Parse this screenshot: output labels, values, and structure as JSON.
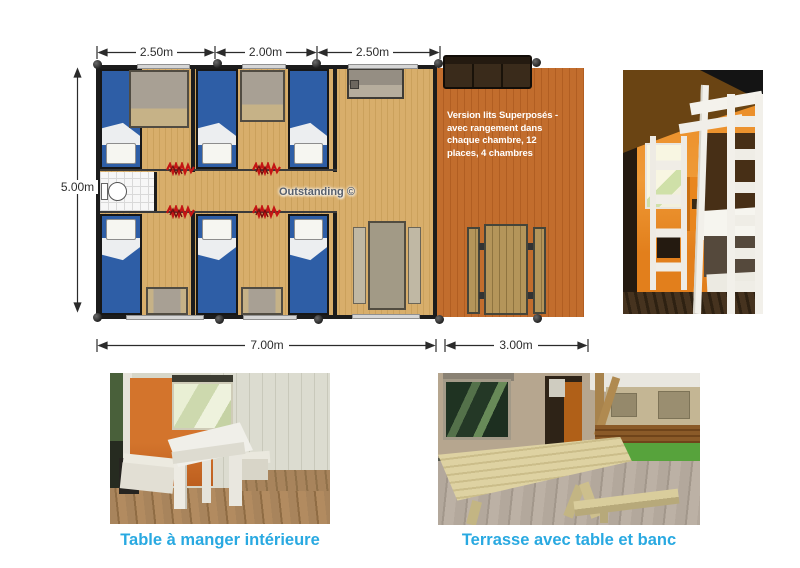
{
  "floorplan": {
    "dims_top": [
      {
        "label": "2.50m"
      },
      {
        "label": "2.00m"
      },
      {
        "label": "2.50m"
      }
    ],
    "dim_left": {
      "label": "5.00m"
    },
    "dims_bottom": [
      {
        "label": "7.00m"
      },
      {
        "label": "3.00m"
      }
    ],
    "note_lines": [
      "Version lits Superposés -",
      "avec rangement dans",
      "chaque chambre, 12",
      "places, 4 chambres"
    ],
    "watermark": "Outstanding ©",
    "icons": {
      "door_curtain": "red-zigzag"
    },
    "colors": {
      "cabin_floor": "#d8ae6b",
      "terrace_deck": "#c26d2d",
      "bed_blue": "#2e5ea6",
      "wall": "#1c1c1c",
      "dimension_text": "#2e2e2e",
      "note_text": "#ffffff"
    }
  },
  "photos": {
    "table_interior": {
      "caption": "Table à manger intérieure"
    },
    "terrace": {
      "caption": "Terrasse avec table et banc"
    }
  },
  "caption_color": "#29a9e1"
}
